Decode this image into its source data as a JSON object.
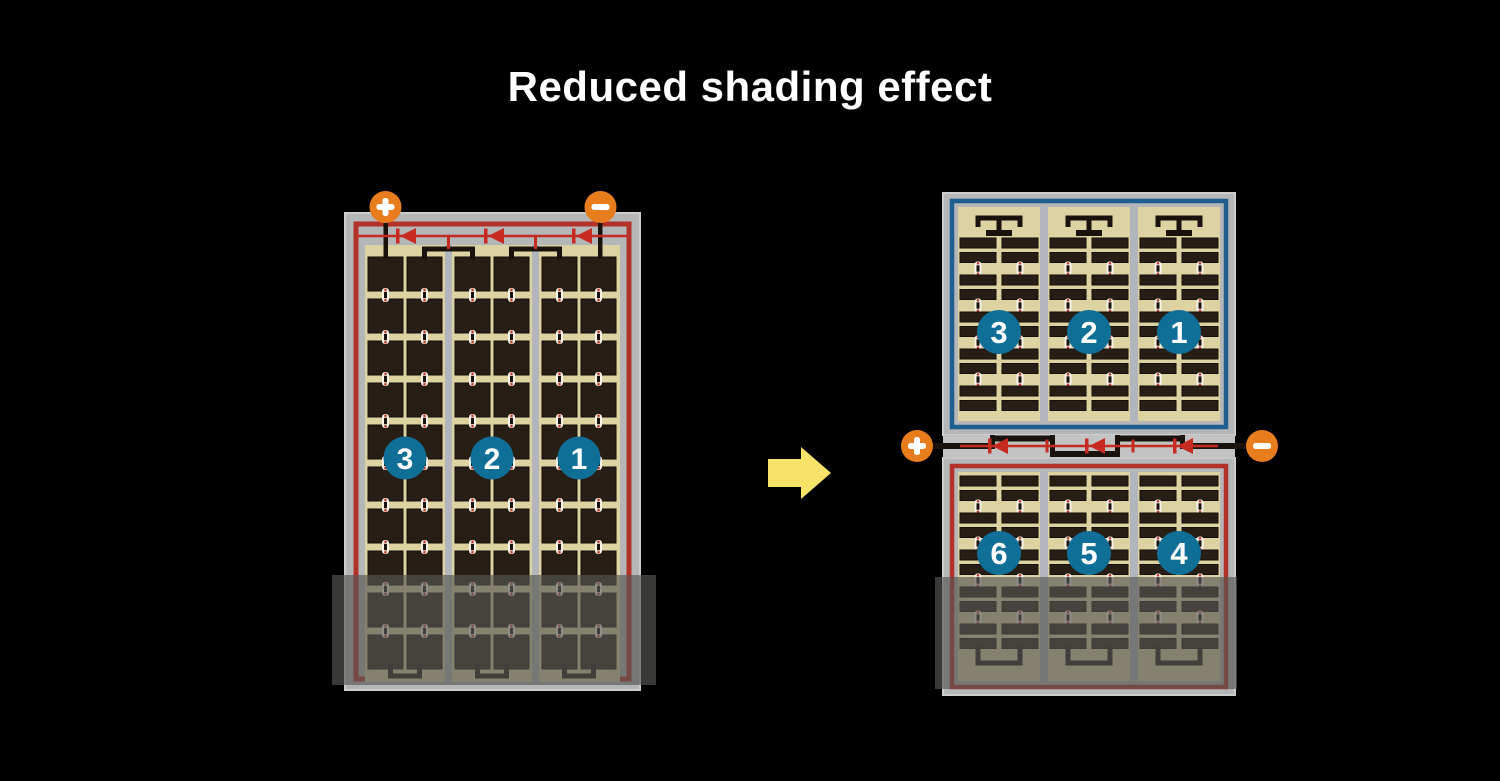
{
  "title": "Reduced shading effect",
  "arrow": {
    "icon": "right-arrow",
    "direction": "right"
  },
  "left_module": {
    "type": "full-cell module, single face",
    "terminals": [
      {
        "symbol": "+"
      },
      {
        "symbol": "−"
      }
    ],
    "strings": [
      {
        "label": "3"
      },
      {
        "label": "2"
      },
      {
        "label": "1"
      }
    ],
    "rows": 10,
    "columns_per_string": 2,
    "bypass_diodes": 3,
    "shaded_region": "bottom"
  },
  "right_module": {
    "type": "half-cut module, split in two halves",
    "terminals": [
      {
        "symbol": "+"
      },
      {
        "symbol": "−"
      }
    ],
    "top_half": {
      "strings": [
        {
          "label": "3"
        },
        {
          "label": "2"
        },
        {
          "label": "1"
        }
      ]
    },
    "bottom_half": {
      "strings": [
        {
          "label": "6"
        },
        {
          "label": "5"
        },
        {
          "label": "4"
        }
      ]
    },
    "strip_pairs_per_half": 5,
    "columns_per_string": 2,
    "bypass_diodes": 3,
    "shaded_region": "bottom"
  },
  "colors": {
    "background": "#000000",
    "title_text": "#ffffff",
    "frame_gray": "#b5b6b7",
    "frame_edge": "#cdcdcd",
    "band_gray": "#c3c3c3",
    "border_red": "#b23129",
    "border_blue": "#1f5f90",
    "cell_bg_tan": "#ddd2a2",
    "cell_dark": "#271e16",
    "cell_outline": "#140e08",
    "divider_gray": "#b2b5bb",
    "terminal_orange": "#e87d1e",
    "terminal_symbol": "#ffffff",
    "wire_black": "#1a130d",
    "wire_red": "#c62b22",
    "connector_white": "#f7f3e8",
    "connector_red": "#c0392b",
    "badge_blue": "#0f6f97",
    "badge_text": "#ffffff",
    "shade_overlay": "rgba(86,86,84,0.66)",
    "arrow_yellow": "#f8e36a"
  }
}
